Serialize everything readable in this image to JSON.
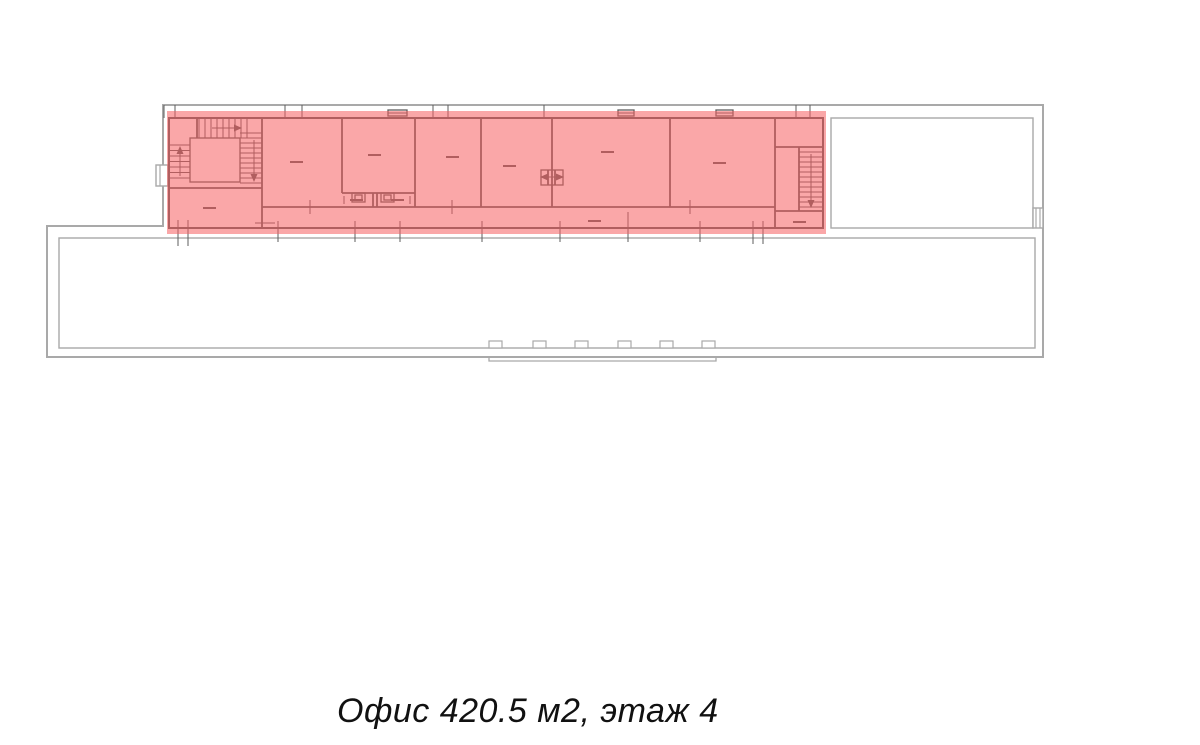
{
  "caption": {
    "text": "Офис 420.5 м2, этаж 4",
    "area_m2": "420.5",
    "floor": "4"
  },
  "colors": {
    "background": "#ffffff",
    "outline": "#a9a9a9",
    "wall": "#5d5d5d",
    "highlight": "#f55e60",
    "highlight_opacity": 0.55,
    "caption_text": "#111111"
  },
  "plan": {
    "highlight": {
      "x": 167,
      "y": 111,
      "w": 659,
      "h": 123
    },
    "grey": {
      "path": "M163 105 H1043 V357 H47 V226 H163 Z",
      "bulge": "M489 357 V361 H716 V357",
      "rects": [
        [
          831,
          118,
          202,
          110,
          "adjacent-room"
        ],
        [
          59,
          238,
          976,
          110,
          "lower-hall"
        ],
        [
          1033,
          208,
          10,
          20,
          "right-wall-window"
        ],
        [
          156,
          165,
          12,
          21,
          "left-wall-bay"
        ]
      ],
      "notch_xs": [
        489,
        533,
        575,
        618,
        660,
        702
      ],
      "lines": [
        [
          1036,
          208,
          1036,
          228
        ],
        [
          1040,
          208,
          1040,
          228
        ],
        [
          160,
          165,
          160,
          186
        ]
      ]
    },
    "office": {
      "rects": [
        [
          169,
          118,
          654,
          110,
          "office-perimeter"
        ],
        [
          190,
          138,
          50,
          44,
          "stair-landing"
        ],
        [
          352,
          193,
          13,
          9,
          "wc-fixture"
        ],
        [
          381,
          193,
          13,
          9,
          "wc-fixture"
        ],
        [
          355,
          195,
          7,
          5,
          "wc-fixture-inner"
        ],
        [
          384,
          195,
          7,
          5,
          "wc-fixture-inner"
        ],
        [
          541,
          170,
          22,
          15,
          "elevator-shaft"
        ],
        [
          388,
          110,
          19,
          6,
          "top-window"
        ],
        [
          618,
          110,
          16,
          6,
          "top-window"
        ],
        [
          716,
          110,
          17,
          6,
          "top-window"
        ]
      ],
      "walls": [
        [
          262,
          118,
          262,
          228
        ],
        [
          342,
          118,
          342,
          193
        ],
        [
          415,
          118,
          415,
          207
        ],
        [
          481,
          118,
          481,
          207
        ],
        [
          552,
          118,
          552,
          207
        ],
        [
          670,
          118,
          670,
          207
        ],
        [
          775,
          118,
          775,
          228
        ],
        [
          262,
          207,
          775,
          207
        ],
        [
          342,
          193,
          415,
          193
        ],
        [
          169,
          188,
          262,
          188
        ],
        [
          775,
          147,
          823,
          147
        ],
        [
          775,
          211,
          823,
          211
        ],
        [
          799,
          147,
          799,
          211
        ],
        [
          373,
          193,
          373,
          207
        ],
        [
          377,
          193,
          377,
          207
        ],
        [
          197,
          118,
          197,
          138
        ],
        [
          548,
          170,
          548,
          185
        ],
        [
          555,
          170,
          555,
          185
        ]
      ],
      "thin": [
        [
          164,
          105,
          164,
          118
        ],
        [
          175,
          105,
          175,
          118
        ],
        [
          285,
          105,
          285,
          118
        ],
        [
          302,
          105,
          302,
          118
        ],
        [
          433,
          105,
          433,
          118
        ],
        [
          448,
          105,
          448,
          118
        ],
        [
          544,
          105,
          544,
          118
        ],
        [
          796,
          105,
          796,
          118
        ],
        [
          810,
          105,
          810,
          118
        ],
        [
          178,
          220,
          178,
          246
        ],
        [
          188,
          220,
          188,
          246
        ],
        [
          278,
          221,
          278,
          242
        ],
        [
          355,
          221,
          355,
          242
        ],
        [
          400,
          221,
          400,
          242
        ],
        [
          482,
          221,
          482,
          242
        ],
        [
          560,
          221,
          560,
          242
        ],
        [
          628,
          212,
          628,
          242
        ],
        [
          700,
          221,
          700,
          242
        ],
        [
          753,
          221,
          753,
          244
        ],
        [
          763,
          221,
          763,
          244
        ],
        [
          310,
          200,
          310,
          214
        ],
        [
          452,
          200,
          452,
          214
        ],
        [
          690,
          200,
          690,
          214
        ],
        [
          255,
          223,
          275,
          223
        ],
        [
          388,
          113,
          407,
          113
        ],
        [
          618,
          113,
          634,
          113
        ],
        [
          716,
          113,
          733,
          113
        ],
        [
          344,
          196,
          344,
          204
        ],
        [
          410,
          196,
          410,
          204
        ]
      ],
      "flights": [
        {
          "axis": "x",
          "from": 199,
          "to": 247,
          "step": 6,
          "a": 118,
          "b": 138
        },
        {
          "axis": "y",
          "from": 145,
          "to": 183,
          "step": 5.5,
          "a": 169,
          "b": 190
        },
        {
          "axis": "y",
          "from": 133,
          "to": 183,
          "step": 5,
          "a": 240,
          "b": 262
        },
        {
          "axis": "y",
          "from": 152,
          "to": 207,
          "step": 5,
          "a": 799,
          "b": 823
        }
      ],
      "arrows": [
        {
          "x1": 212,
          "y1": 128,
          "x2": 236,
          "y2": 128,
          "head": "right"
        },
        {
          "x1": 180,
          "y1": 176,
          "x2": 180,
          "y2": 152,
          "head": "up"
        },
        {
          "x1": 254,
          "y1": 140,
          "x2": 254,
          "y2": 176,
          "head": "down"
        },
        {
          "x1": 811,
          "y1": 154,
          "x2": 811,
          "y2": 202,
          "head": "down"
        },
        {
          "x1": 552,
          "y1": 177,
          "x2": 546,
          "y2": 177,
          "head": "left"
        },
        {
          "x1": 552,
          "y1": 177,
          "x2": 558,
          "y2": 177,
          "head": "right"
        }
      ],
      "dashes": [
        [
          203,
          208
        ],
        [
          290,
          162
        ],
        [
          368,
          155
        ],
        [
          446,
          157
        ],
        [
          503,
          166
        ],
        [
          601,
          152
        ],
        [
          713,
          163
        ],
        [
          588,
          221
        ],
        [
          793,
          222
        ],
        [
          350,
          200
        ],
        [
          391,
          200
        ]
      ]
    }
  }
}
